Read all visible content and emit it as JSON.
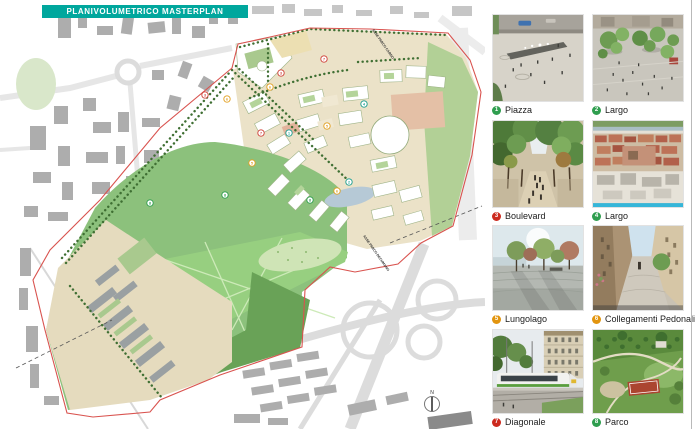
{
  "banner": {
    "text": "PLANIVOLUMETRICO MASTERPLAN",
    "bg": "#00a79d",
    "fg": "#ffffff"
  },
  "map": {
    "axis_labels": [
      {
        "text": "ASSE PARCO CARDO"
      },
      {
        "text": "ASSE PARCO DECUMANO"
      }
    ],
    "north_label": "N",
    "boundary_color": "#d9534f",
    "markers": [
      {
        "number": "3",
        "color": "#d04038",
        "x": 205,
        "y": 95
      },
      {
        "number": "6",
        "color": "#e2a020",
        "x": 227,
        "y": 99
      },
      {
        "number": "7",
        "color": "#d04038",
        "x": 324,
        "y": 59
      },
      {
        "number": "3",
        "color": "#d04038",
        "x": 281,
        "y": 73
      },
      {
        "number": "6",
        "color": "#e2a020",
        "x": 270,
        "y": 87
      },
      {
        "number": "4",
        "color": "#1a9e8f",
        "x": 364,
        "y": 104
      },
      {
        "number": "5",
        "color": "#e2a020",
        "x": 327,
        "y": 126
      },
      {
        "number": "7",
        "color": "#d04038",
        "x": 261,
        "y": 133
      },
      {
        "number": "1",
        "color": "#1a9e8f",
        "x": 289,
        "y": 133
      },
      {
        "number": "5",
        "color": "#e2a020",
        "x": 252,
        "y": 163
      },
      {
        "number": "2",
        "color": "#1a9e8f",
        "x": 349,
        "y": 182
      },
      {
        "number": "6",
        "color": "#e2a020",
        "x": 337,
        "y": 191
      },
      {
        "number": "8",
        "color": "#2f9e4f",
        "x": 310,
        "y": 200
      },
      {
        "number": "8",
        "color": "#2f9e4f",
        "x": 150,
        "y": 203
      },
      {
        "number": "8",
        "color": "#2f9e4f",
        "x": 225,
        "y": 195
      }
    ]
  },
  "legend": {
    "items": [
      {
        "number": "1",
        "label": "Piazza",
        "color": "#2f9e4f"
      },
      {
        "number": "2",
        "label": "Largo",
        "color": "#2f9e4f"
      },
      {
        "number": "3",
        "label": "Boulevard",
        "color": "#cc2a1e"
      },
      {
        "number": "4",
        "label": "Largo",
        "color": "#2f9e4f"
      },
      {
        "number": "5",
        "label": "Lungolago",
        "color": "#e2950f"
      },
      {
        "number": "6",
        "label": "Collegamenti Pedonali",
        "color": "#e2950f"
      },
      {
        "number": "7",
        "label": "Diagonale",
        "color": "#cc2a1e"
      },
      {
        "number": "8",
        "label": "Parco",
        "color": "#2f9e4f"
      }
    ]
  }
}
